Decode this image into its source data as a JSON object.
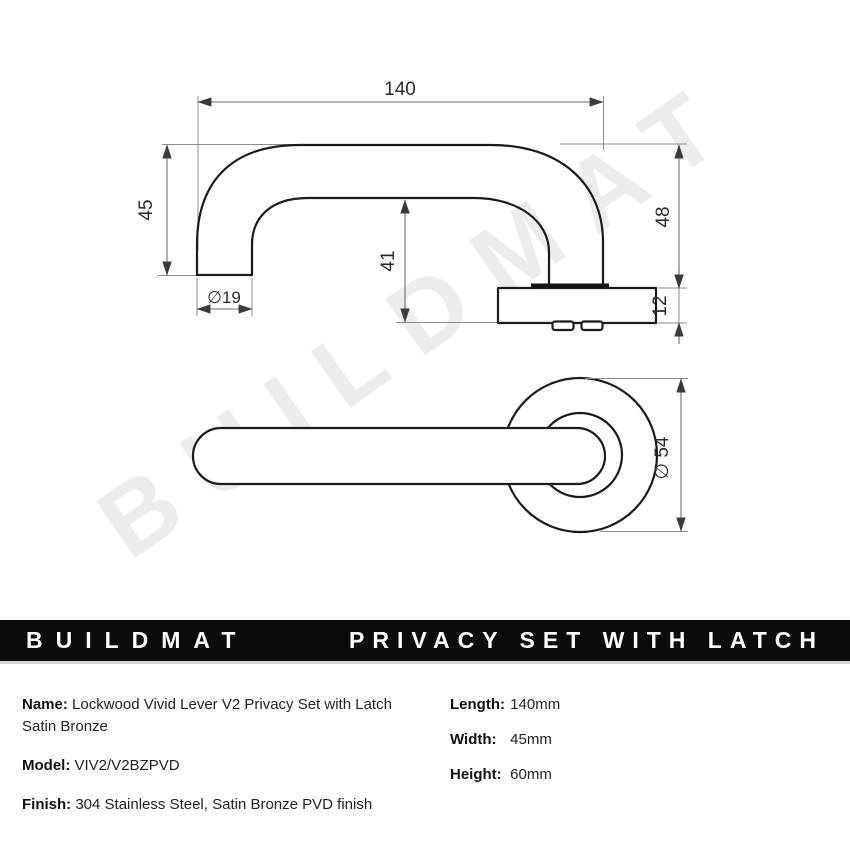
{
  "watermark": {
    "text": "BUILDMAT"
  },
  "banner": {
    "brand": "BUILDMAT",
    "title": "PRIVACY SET WITH LATCH"
  },
  "drawing": {
    "side_view": {
      "length": "140",
      "grip_height": "45",
      "grip_diameter": "∅19",
      "neck_height": "41",
      "total_height": "48",
      "rose_depth": "12"
    },
    "front_view": {
      "rose_diameter": "∅ 54"
    }
  },
  "specs": {
    "name_label": "Name:",
    "name_value": "Lockwood Vivid Lever V2 Privacy Set with Latch Satin Bronze",
    "model_label": "Model:",
    "model_value": "VIV2/V2BZPVD",
    "finish_label": "Finish:",
    "finish_value": "304 Stainless Steel, Satin Bronze PVD finish",
    "length_label": "Length:",
    "length_value": "140mm",
    "width_label": "Width:",
    "width_value": "45mm",
    "height_label": "Height:",
    "height_value": "60mm"
  }
}
